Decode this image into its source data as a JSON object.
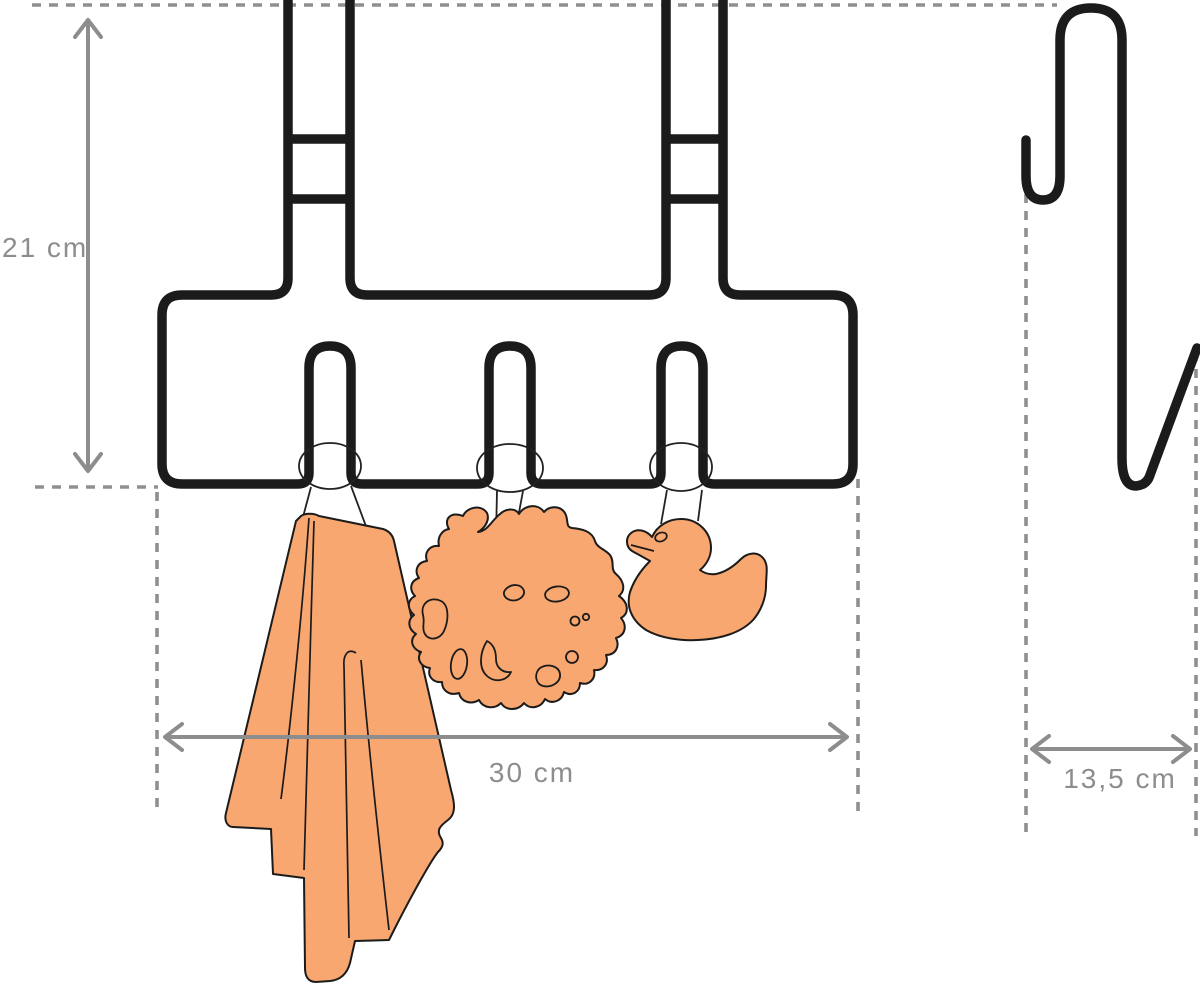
{
  "diagram": {
    "title": "Over-door hook rack dimension drawing",
    "measurements": {
      "height": {
        "label": "21 cm"
      },
      "width": {
        "label": "30 cm"
      },
      "depth": {
        "label": "13,5 cm"
      }
    },
    "views": {
      "front": "front view of over-door rack with 3 hooks",
      "side": "side profile of door bracket hook"
    },
    "items": [
      "towel",
      "bath-sponge",
      "rubber-duck"
    ],
    "colors": {
      "item_fill": "#F7A76F",
      "outline": "#1B1B1B",
      "dimension": "#8D8D8D",
      "guide": "#8F8F8F"
    }
  }
}
